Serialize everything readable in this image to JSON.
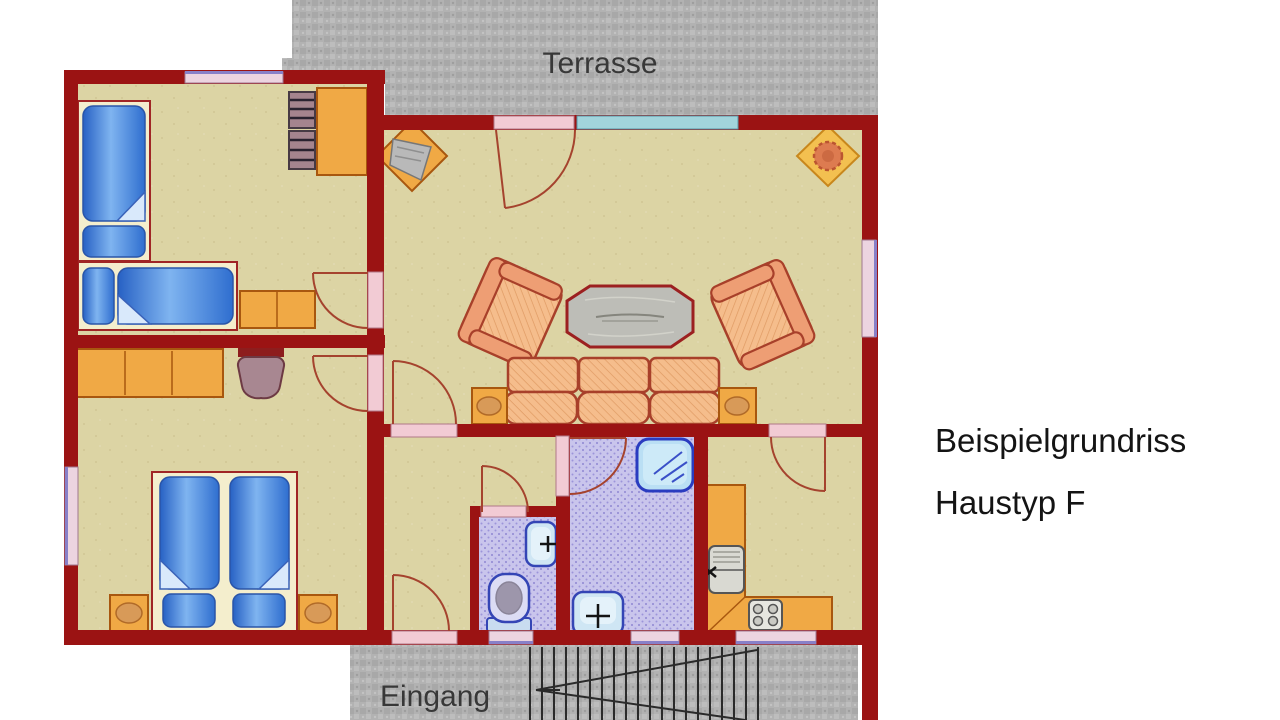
{
  "caption": {
    "line1": "Beispielgrundriss",
    "line2": "Haustyp F"
  },
  "labels": {
    "terrace": "Terrasse",
    "entrance": "Eingang"
  },
  "colors": {
    "wall_red": "#9b1313",
    "floor_beige": "#dcd4a4",
    "wet_floor": "#c9c5ec",
    "terrace_gray": "#b2b2b2",
    "furniture_wood": "#f0a945",
    "furniture_wood_border": "#a8570f",
    "upholstery": "#f5bd8c",
    "upholstery_border": "#a8402a",
    "bed_frame": "#f4eecd",
    "bed_blue": "#3f7fdc",
    "window_pink": "#ecd4e0",
    "window_teal": "#a2d4dc",
    "fixture_blue": "#cfe6f4",
    "fixture_border": "#3445b5",
    "door_line": "#a5432e",
    "text_dark": "#141414"
  }
}
